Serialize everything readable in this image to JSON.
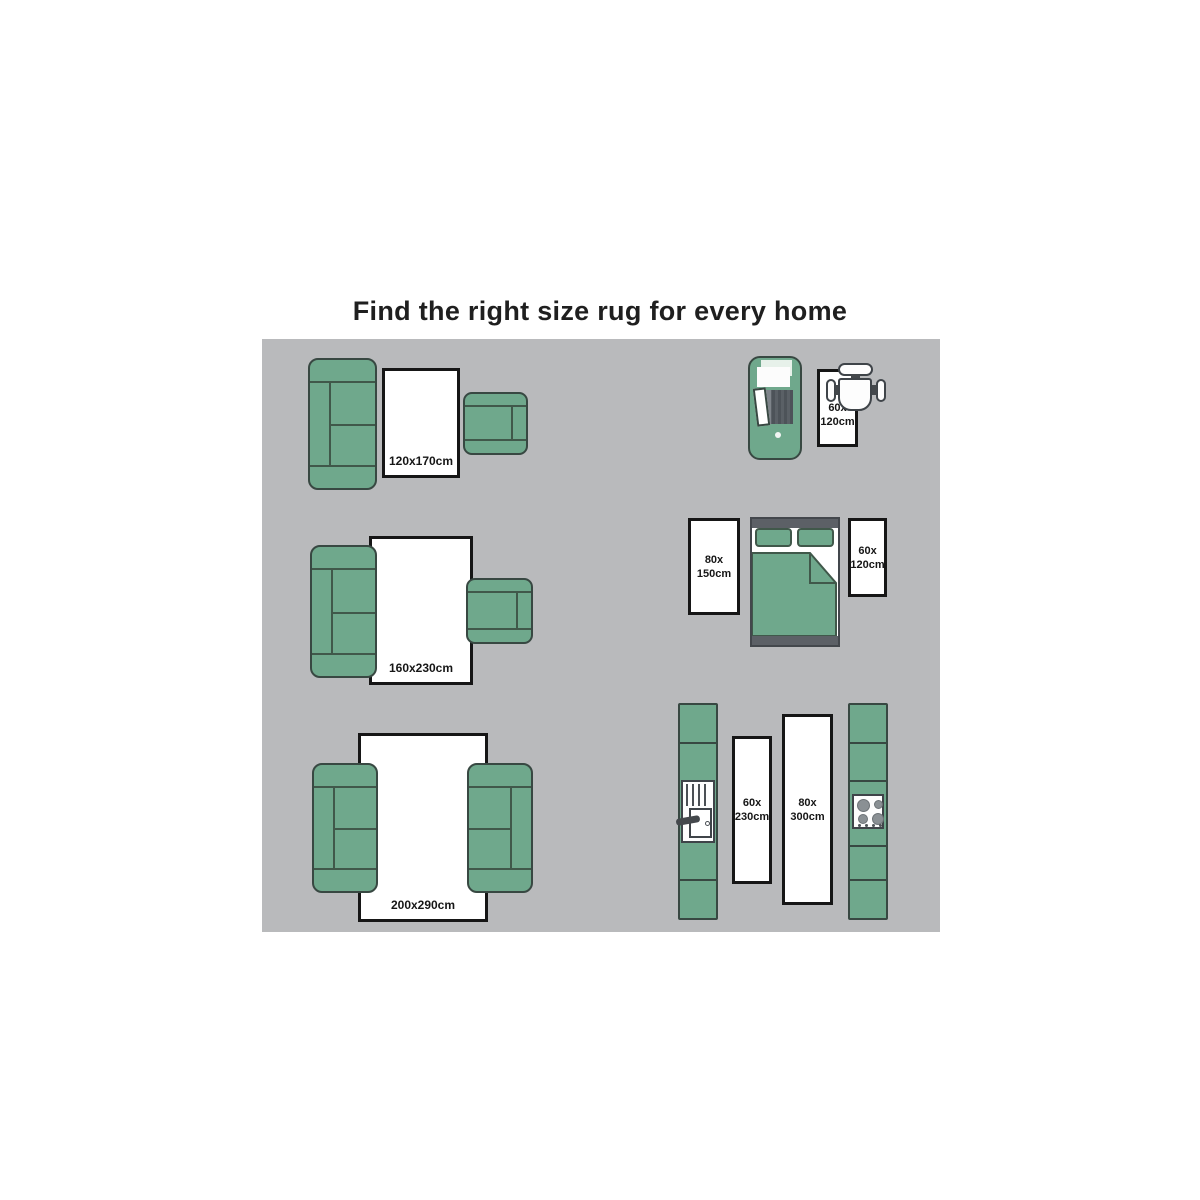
{
  "title": "Find the right size rug for every home",
  "colors": {
    "panel_bg": "#b9babc",
    "furniture_green": "#6fa88c",
    "furniture_outline": "#384842",
    "seam_line": "#40584a",
    "rug_bg": "#ffffff",
    "rug_border": "#161616",
    "label_text": "#161616",
    "bed_frame_gray": "#5c6066",
    "appliance_outline": "#3f4449"
  },
  "icons": {
    "sofa": "sofa-top-view-icon (css-shape)",
    "armchair": "armchair-top-view-icon (css-shape)",
    "bed": "double-bed-top-view-icon (css-shape)",
    "desk_chair": "desk-chair-top-view-icon (css-shape)",
    "entry_closet": "entry-door-top-view-icon (css-shape)",
    "kitchen_sink": "kitchen-sink-top-view-icon (css-shape)",
    "kitchen_stove": "stove-cooktop-top-view-icon (css-shape)"
  },
  "rugs": {
    "living_small": {
      "label": "120x170cm"
    },
    "living_medium": {
      "label": "160x230cm"
    },
    "living_large": {
      "label": "200x290cm"
    },
    "desk": {
      "line1": "60x",
      "line2": "120cm"
    },
    "bedroom_left": {
      "line1": "80x",
      "line2": "150cm"
    },
    "bedroom_right": {
      "line1": "60x",
      "line2": "120cm"
    },
    "kitchen_left": {
      "line1": "60x",
      "line2": "230cm"
    },
    "kitchen_right": {
      "line1": "80x",
      "line2": "300cm"
    }
  }
}
